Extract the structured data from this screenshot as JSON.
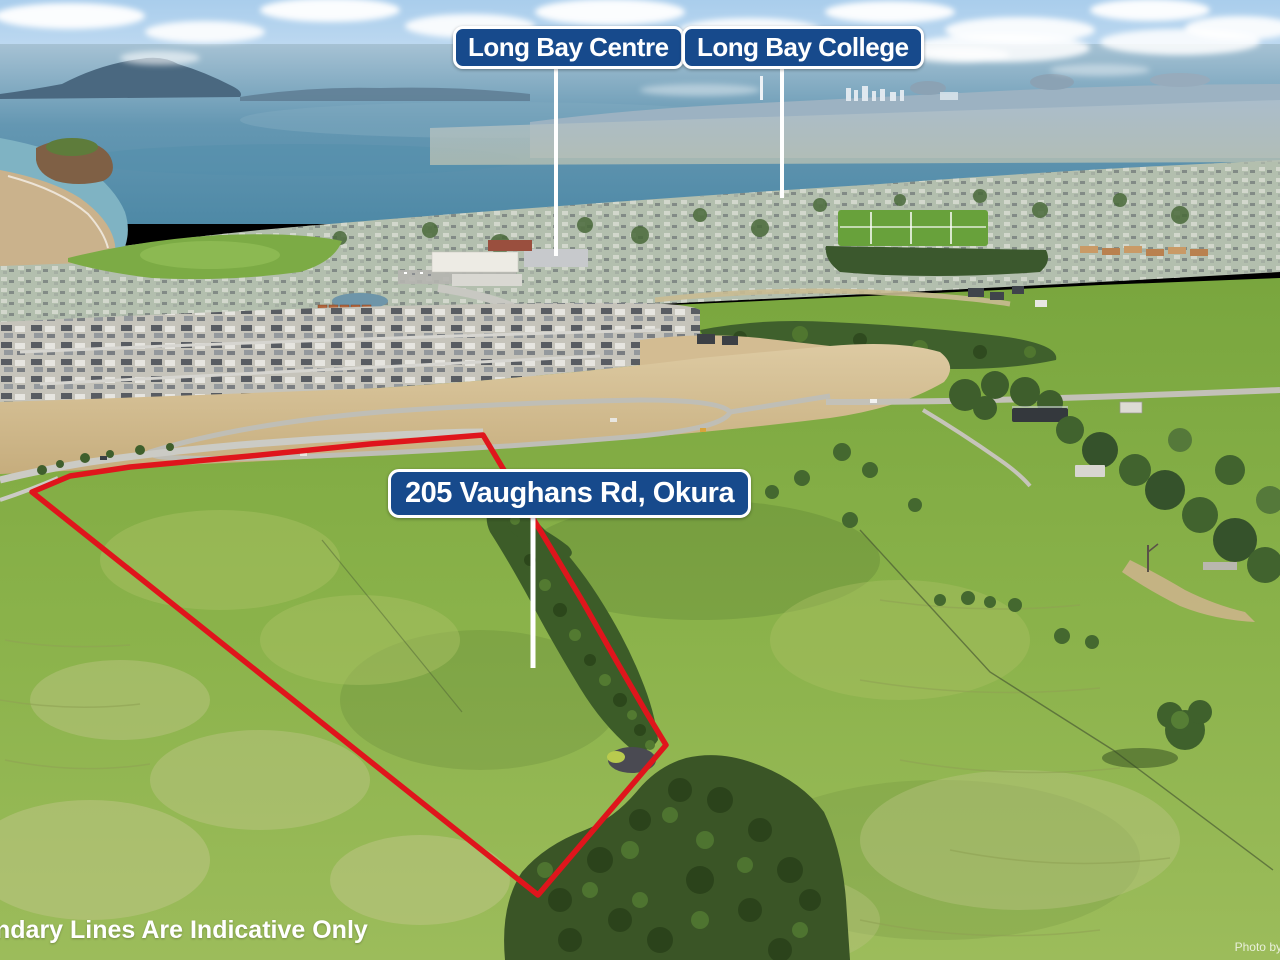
{
  "overlays": {
    "labels": [
      {
        "id": "long-bay-centre",
        "text": "Long Bay Centre"
      },
      {
        "id": "long-bay-college",
        "text": "Long Bay College"
      },
      {
        "id": "property-address",
        "text": "205 Vaughans Rd, Okura"
      }
    ],
    "disclaimer": "ndary Lines Are Indicative Only",
    "watermark": "Photo by"
  },
  "colors": {
    "label_background": "#174a8c",
    "label_border": "#ffffff",
    "label_text": "#ffffff",
    "overlay_text": "#ffffff",
    "boundary_red": "#df151c",
    "callout_line": "#ffffff"
  },
  "palette": {
    "sky": "#b3d2ee",
    "sea": "#5e93af",
    "pasture": "#86ad49",
    "bush": "#3a5526",
    "earthworks": "#d3bc92"
  }
}
